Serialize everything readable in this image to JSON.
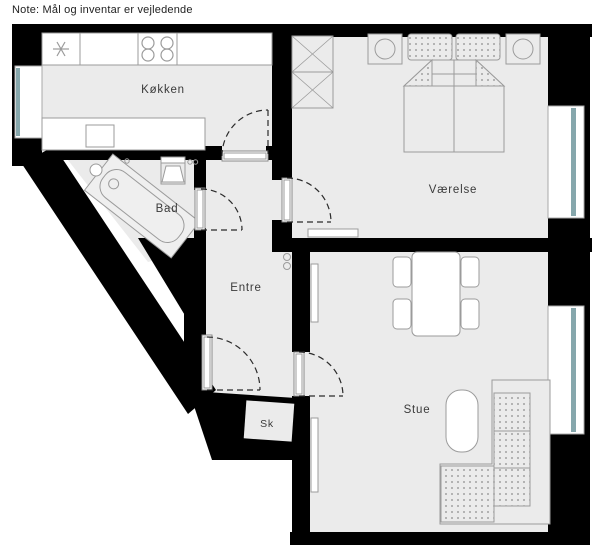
{
  "note": "Note: Mål og inventar er vejledende",
  "rooms": {
    "kitchen": "Køkken",
    "bathroom": "Bad",
    "hallway": "Entre",
    "closet": "Sk",
    "bedroom": "Værelse",
    "living_room": "Stue"
  },
  "colors": {
    "wall": "#000000",
    "floor": "#ebebeb",
    "window_glass": "#86a7ac",
    "furniture_line": "#9b9b9b",
    "label_text": "#3a3a3a"
  }
}
